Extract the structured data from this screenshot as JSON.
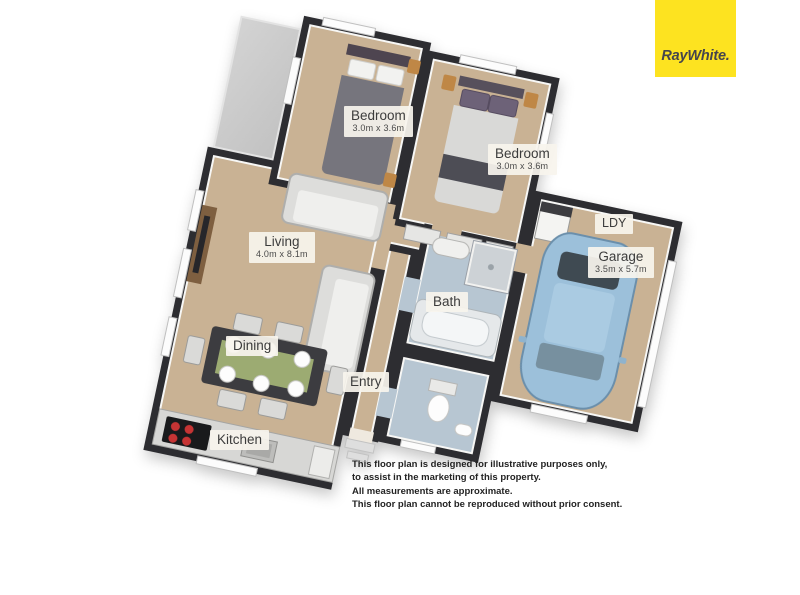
{
  "brand": {
    "name": "RayWhite."
  },
  "floorplan": {
    "rooms": {
      "bedroom1": {
        "label": "Bedroom",
        "dims": "3.0m x 3.6m"
      },
      "bedroom2": {
        "label": "Bedroom",
        "dims": "3.0m x 3.6m"
      },
      "living": {
        "label": "Living",
        "dims": "4.0m x 8.1m"
      },
      "dining": {
        "label": "Dining"
      },
      "kitchen": {
        "label": "Kitchen"
      },
      "entry": {
        "label": "Entry"
      },
      "bath": {
        "label": "Bath"
      },
      "garage": {
        "label": "Garage",
        "dims": "3.5m x 5.7m"
      },
      "laundry": {
        "label": "LDY"
      }
    },
    "colors": {
      "wall": "#2d2d31",
      "floor": "#c9b294",
      "bath_floor": "#b7c6d2",
      "deck": "#cacaca",
      "car_body": "#9cc0da",
      "dining_runner": "#9cab72",
      "burner_red": "#c63434",
      "logo_yellow": "#fde320"
    }
  },
  "disclaimer": {
    "lines": [
      "This floor plan is designed for illustrative purposes only,",
      "to assist in the marketing of this property.",
      "All measurements are approximate.",
      "This floor plan cannot be reproduced without prior consent."
    ]
  }
}
